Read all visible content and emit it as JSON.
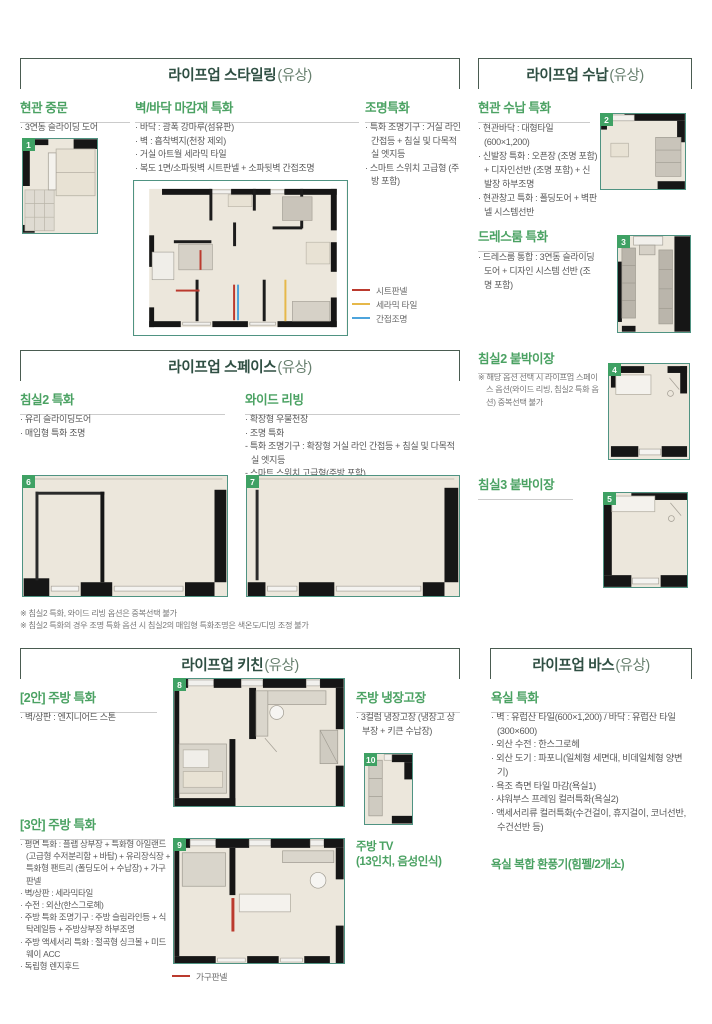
{
  "colors": {
    "section_title": "#2f4f43",
    "subheading_green": "#4ba263",
    "body_text": "#595959",
    "thumb_border": "#4f9382",
    "badge_green": "#3fa164",
    "legend_sheet_red": "#bb3a2e",
    "legend_ceramic_yellow": "#e6b84a",
    "legend_indirect_blue": "#4da4dc",
    "legend_furniture_red": "#bb3a2e"
  },
  "styling": {
    "title": "라이프업 스타일링",
    "suffix": "(유상)",
    "door": {
      "heading": "현관 중문",
      "items": [
        "· 3연동 슬라이딩 도어"
      ],
      "badge": "1"
    },
    "finish": {
      "heading": "벽/바닥 마감재 특화",
      "items": [
        "· 바닥 : 광폭 강마루(섬유판)",
        "· 벽 : 흡착벽지(천장 제외)",
        "· 거실 아트월 세라믹 타일",
        "· 복도 1면/소파뒷벽 시트판넬 + 소파뒷벽 간접조명"
      ]
    },
    "lighting": {
      "heading": "조명특화",
      "items": [
        "· 특화 조명기구 : 거실 라인 간접등 + 침실 및 다목적실 엣지등",
        "· 스마트 스위치 고급형 (주방 포함)"
      ]
    },
    "legend": [
      {
        "label": "시트판넬",
        "color": "#bb3a2e"
      },
      {
        "label": "세라믹 타일",
        "color": "#e6b84a"
      },
      {
        "label": "간접조명",
        "color": "#4da4dc"
      }
    ]
  },
  "storage": {
    "title": "라이프업 수납",
    "suffix": "(유상)",
    "entrance": {
      "heading": "현관 수납 특화",
      "items": [
        "· 현관바닥 : 대형타일 (600×1,200)",
        "· 신발장 특화 : 오픈장 (조명 포함) + 디자인선반 (조명 포함) + 신발장 하부조명",
        "· 현관창고 특화 : 폴딩도어 + 벽판넬 시스템선반"
      ],
      "badge": "2"
    },
    "dressroom": {
      "heading": "드레스룸 특화",
      "items": [
        "· 드레스룸 통합 : 3연동 슬라이딩도어 + 디자인 시스템 선반 (조명 포함)"
      ],
      "badge": "3"
    },
    "bedroom2": {
      "heading": "침실2 붙박이장",
      "note": "※ 해당 옵션 선택 시 라이프업 스페이스 옵션(와이드 리빙, 침실2 특화 옵션) 중복선택 불가",
      "badge": "4"
    },
    "bedroom3": {
      "heading": "침실3 붙박이장",
      "badge": "5"
    }
  },
  "space": {
    "title": "라이프업 스페이스",
    "suffix": "(유상)",
    "bedroom2": {
      "heading": "침실2 특화",
      "items": [
        "· 유리 슬라이딩도어",
        "· 매입형 특화 조명"
      ],
      "badge": "6"
    },
    "wide_living": {
      "heading": "와이드 리빙",
      "items": [
        "· 확장형 우물천장",
        "· 조명 특화",
        "- 특화 조명기구 : 확장형 거실 라인 간접등 + 침실 및 다목적실 엣지등",
        "- 스마트 스위치 고급형(주방 포함)"
      ],
      "badge": "7"
    },
    "notes": [
      "※ 침실2 특화, 와이드 리빙 옵션은 중복선택 불가",
      "※ 침실2 특화의 경우 조명 특화 옵션 시 침실2의 매입형 특화조명은 색온도/디밍 조정 불가"
    ]
  },
  "kitchen": {
    "title": "라이프업 키친",
    "suffix": "(유상)",
    "plan2": {
      "heading": "[2안] 주방 특화",
      "items": [
        "· 벽/상판 : 엔지니어드 스톤"
      ],
      "badge": "8"
    },
    "fridge": {
      "heading": "주방 냉장고장",
      "items": [
        "· 3컬럼 냉장고장 (냉장고 상부장 + 키큰 수납장)"
      ],
      "badge": "10"
    },
    "plan3": {
      "heading": "[3안] 주방 특화",
      "items": [
        "· 평면 특화 : 플랩 상부장 + 특화형 아일랜드(고급형 수저분리함 + 바탑) + 유리장식장 + 특화형 팬트리 (폴딩도어 + 수납장) + 가구판넬",
        "· 벽/상판 : 세라믹타일",
        "· 수전 : 외산(한스그로헤)",
        "· 주방 특화 조명기구 : 주방 슬림라인등 + 식탁레일등 + 주방상부장 하부조명",
        "· 주방 액세서리 특화 : 절곡형 싱크볼 + 미드웨이 ACC",
        "· 독립형 렌지후드"
      ],
      "badge": "9"
    },
    "tv_heading": "주방 TV",
    "tv_sub": "(13인치, 음성인식)",
    "legend": [
      {
        "label": "가구판넬",
        "color": "#bb3a2e"
      }
    ]
  },
  "bath": {
    "title": "라이프업 바스",
    "suffix": "(유상)",
    "bathroom": {
      "heading": "욕실 특화",
      "items": [
        "· 벽 : 유럽산 타일(600×1,200) / 바닥 : 유럽산 타일(300×600)",
        "· 외산 수전 : 한스그로헤",
        "· 외산 도기 : 파포니(일체형 세면대, 비데일체형 양변기)",
        "· 욕조 측면 타일 마감(욕실1)",
        "· 샤워부스 프레임 컬러특화(욕실2)",
        "· 액세서리류 컬러특화(수건걸이, 휴지걸이, 코너선반, 수건선반 등)"
      ]
    },
    "fan_heading": "욕실 복합 환풍기(힘펠/2개소)"
  }
}
